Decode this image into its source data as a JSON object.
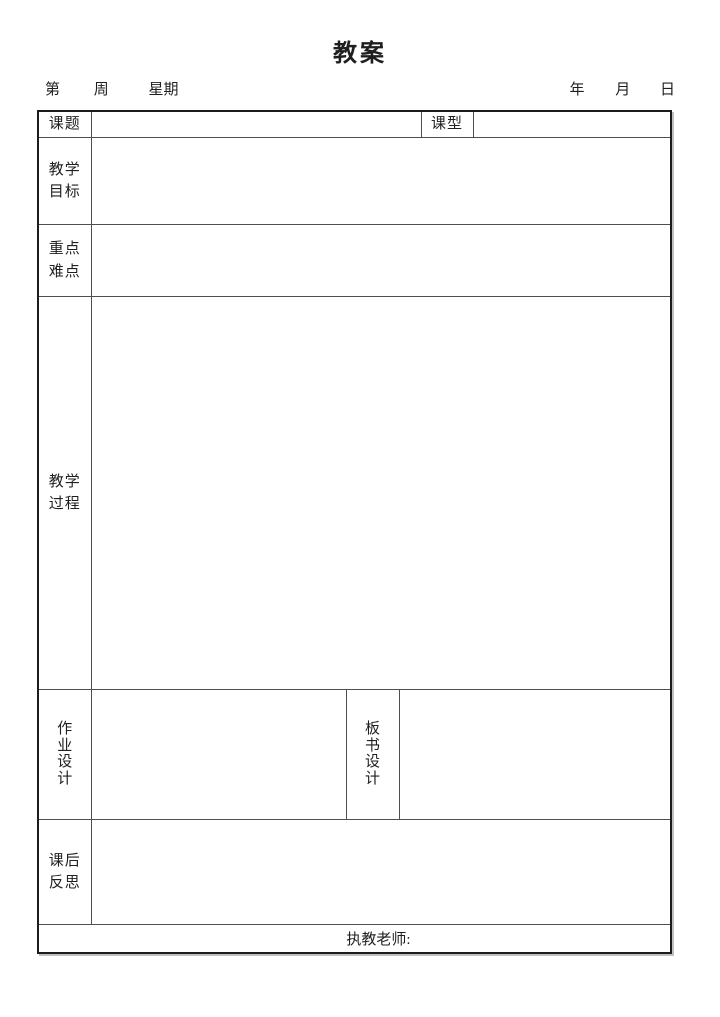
{
  "title": "教案",
  "header": {
    "left_parts": [
      "第",
      "周",
      "星期"
    ],
    "right_parts": [
      "年",
      "月",
      "日"
    ]
  },
  "form": {
    "topic": {
      "label": "课题",
      "value": ""
    },
    "lesson_type": {
      "label": "课型",
      "value": ""
    },
    "objectives": {
      "label": "教学\n目标",
      "value": ""
    },
    "key_points": {
      "label": "重点\n难点",
      "value": ""
    },
    "process": {
      "label": "教学\n过程",
      "value": ""
    },
    "homework": {
      "label": "作\n业\n设\n计",
      "value": ""
    },
    "board": {
      "label": "板\n书\n设\n计",
      "value": ""
    },
    "reflection": {
      "label": "课后\n反思",
      "value": ""
    },
    "teacher": {
      "label": "执教老师:",
      "value": ""
    }
  },
  "colors": {
    "page_bg": "#ffffff",
    "text": "#1f1f1f",
    "border_outer": "#1c1c1c",
    "border_inner": "#4f4f4f"
  }
}
